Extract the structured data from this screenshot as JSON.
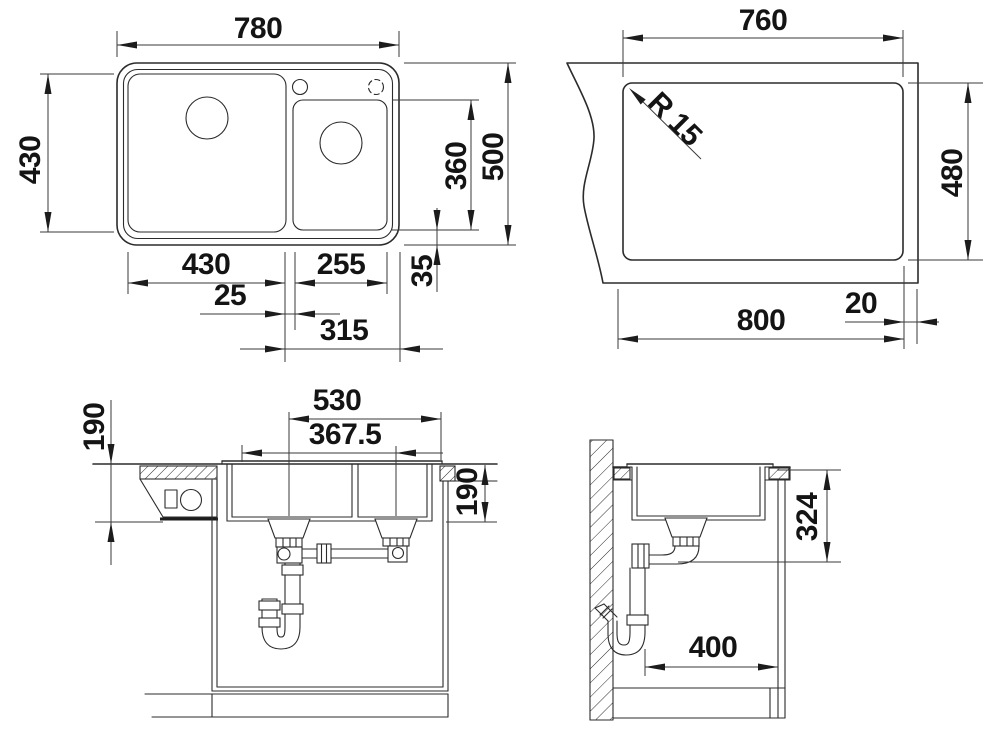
{
  "drawing": {
    "kind": "sink-installation-dimension-drawing",
    "background_color": "#ffffff",
    "line_color": "#2b2b2b",
    "text_color": "#141414"
  },
  "views": {
    "plan": {
      "overall_width": "780",
      "left_bowl_depth": "430",
      "overall_depth": "500",
      "right_bowl_depth": "360",
      "rear_edge_gap": "35",
      "left_bowl_width": "430",
      "right_bowl_width": "255",
      "divider_width": "25",
      "right_section_width": "315"
    },
    "cutout": {
      "cutout_width": "760",
      "cutout_depth": "480",
      "corner_radius": "R 15",
      "cabinet_width": "800",
      "edge_distance": "20"
    },
    "front_section": {
      "drain_span": "530",
      "drain_offset": "367.5",
      "bowl_depth_left": "190",
      "bowl_depth_right": "190"
    },
    "side_section": {
      "outlet_height": "324",
      "clearance_width": "400"
    }
  }
}
